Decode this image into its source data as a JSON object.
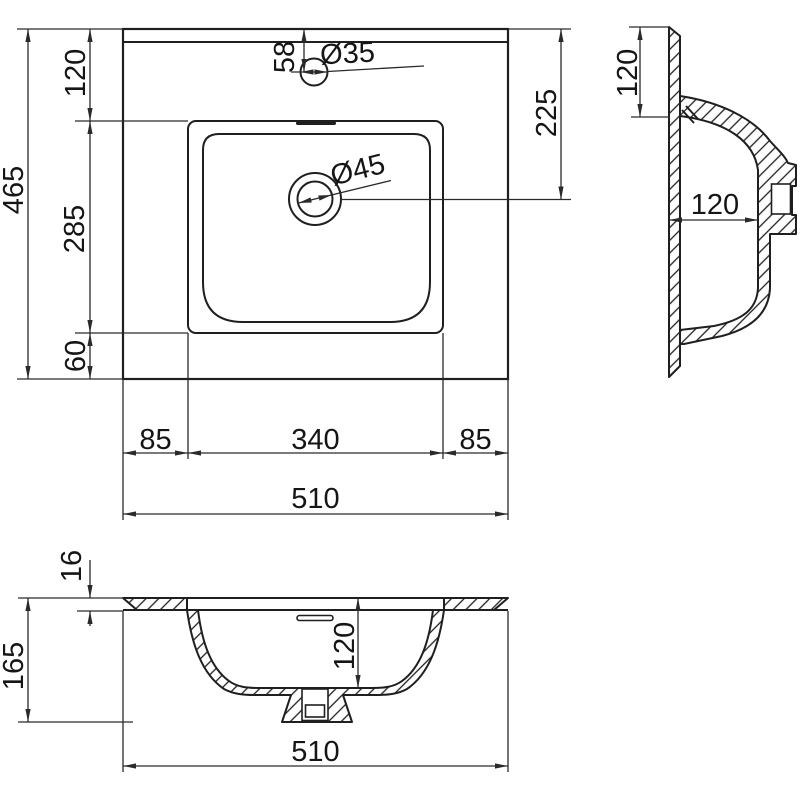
{
  "drawing": {
    "plan": {
      "overall_depth": "465",
      "back_margin": "120",
      "bowl_length": "285",
      "front_margin": "60",
      "faucet_offset": "58",
      "faucet_hole_dia": "Ø35",
      "drain_dia": "Ø45",
      "drain_from_back": "225",
      "left_margin": "85",
      "bowl_width": "340",
      "right_margin": "85",
      "overall_width": "510"
    },
    "side": {
      "deck_width": "120",
      "bowl_depth": "120"
    },
    "front": {
      "rim_thickness": "16",
      "overall_height": "165",
      "bowl_inner_depth": "120",
      "overall_width": "510"
    },
    "colors": {
      "line": "#1f1f1f",
      "dimension": "#2a2a2a",
      "background": "#ffffff"
    }
  }
}
